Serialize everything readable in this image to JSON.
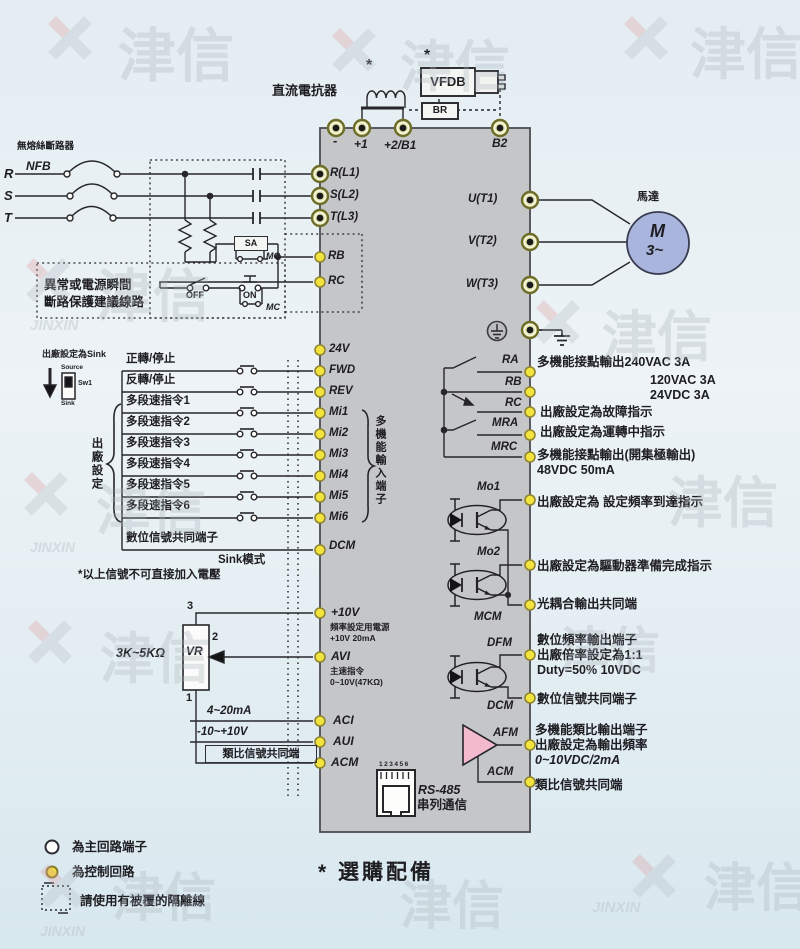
{
  "colors": {
    "background": "#e3edf2",
    "block": "#c5c6c8",
    "wire": "#26262b",
    "terminal_control": "#f2e43c",
    "terminal_main_ring": "#e3e3ab",
    "motor_fill": "#a9b5dd",
    "amp_fill": "#f3b9cc"
  },
  "top": {
    "star": "*",
    "dc_reactor": "直流電抗器",
    "vfdb": "VFDB",
    "br": "BR",
    "t_minus": "-",
    "t_plus1": "+1",
    "t_plus2b1": "+2/B1",
    "t_b2": "B2"
  },
  "power_input": {
    "breaker": "無熔絲斷路器",
    "nfb": "NFB",
    "phase_r": "R",
    "phase_s": "S",
    "phase_t": "T",
    "prot_line1": "異常或電源瞬間",
    "prot_line2": "斷路保護建議線路",
    "sa": "SA",
    "mc_top": "MC",
    "off": "OFF",
    "on": "ON",
    "mc_bottom": "MC"
  },
  "block": {
    "rl1": "R(L1)",
    "sl2": "S(L2)",
    "tl3": "T(L3)",
    "rb": "RB",
    "rc": "RC",
    "v24": "24V",
    "fwd": "FWD",
    "rev": "REV",
    "mi1": "Mi1",
    "mi2": "Mi2",
    "mi3": "Mi3",
    "mi4": "Mi4",
    "mi5": "Mi5",
    "mi6": "Mi6",
    "dcm": "DCM",
    "input_group": "多機能輸入端子",
    "p10v": "+10V",
    "p10v_desc1": "頻率設定用電源",
    "p10v_desc2": "+10V 20mA",
    "avi": "AVI",
    "avi_desc1": "主速指令",
    "avi_desc2": "0~10V(47KΩ)",
    "aci": "ACI",
    "aui": "AUI",
    "acm": "ACM",
    "rs485_pins": "123456",
    "rs485": "RS-485",
    "rs485_label": "串列通信",
    "ut1": "U(T1)",
    "vt2": "V(T2)",
    "wt3": "W(T3)",
    "ra": "RA",
    "rb_out": "RB",
    "rc_out": "RC",
    "mra": "MRA",
    "mrc": "MRC",
    "mo1": "Mo1",
    "mo2": "Mo2",
    "mcm": "MCM",
    "dfm": "DFM",
    "dcm_out": "DCM",
    "afm": "AFM",
    "acm_out": "ACM"
  },
  "digital_inputs": {
    "sink_note": "出廠設定為Sink",
    "source": "Source",
    "sw1": "Sw1",
    "sink": "Sink",
    "factory": "出廠設定",
    "row_fwd": "正轉/停止",
    "row_rev": "反轉/停止",
    "row_mi1": "多段速指令1",
    "row_mi2": "多段速指令2",
    "row_mi3": "多段速指令3",
    "row_mi4": "多段速指令4",
    "row_mi5": "多段速指令5",
    "row_mi6": "多段速指令6",
    "row_dcm": "數位信號共同端子",
    "sink_mode": "Sink模式",
    "warning": "*以上信號不可直接加入電壓"
  },
  "analog_inputs": {
    "pot": "3K~5KΩ",
    "vr": "VR",
    "pin3": "3",
    "pin2": "2",
    "pin1": "1",
    "aci_src": "4~20mA",
    "aui_src": "-10~+10V",
    "acm_src": "類比信號共同端"
  },
  "motor": {
    "label": "馬達",
    "m": "M",
    "phase": "3~"
  },
  "outputs": {
    "relay_desc1": "多機能接點輸出240VAC 3A",
    "relay_desc2": "120VAC 3A",
    "relay_desc3": "24VDC 3A",
    "rc_desc": "出廠設定為故障指示",
    "mra_desc": "出廠設定為運轉中指示",
    "mrc_desc1": "多機能接點輸出(開集極輸出)",
    "mrc_desc2": "48VDC 50mA",
    "mo1_desc": "出廠設定為 設定頻率到達指示",
    "mo2_desc": "出廠設定為驅動器準備完成指示",
    "mcm_desc": "光耦合輸出共同端",
    "dfm_desc1": "數位頻率輸出端子",
    "dfm_desc2": "出廠倍率設定為1:1",
    "dfm_desc3": "Duty=50% 10VDC",
    "dcm_desc": "數位信號共同端子",
    "afm_desc1": "多機能類比輸出端子",
    "afm_desc2": "出廠設定為輸出頻率",
    "afm_desc3": "0~10VDC/2mA",
    "acm_desc": "類比信號共同端"
  },
  "legend": {
    "main_terminal": "為主回路端子",
    "control_circuit": "為控制回路",
    "shielded": "請使用有被覆的隔離線",
    "optional": "* 選購配備"
  },
  "watermark": {
    "cn": "津信",
    "en": "JINXIN"
  }
}
